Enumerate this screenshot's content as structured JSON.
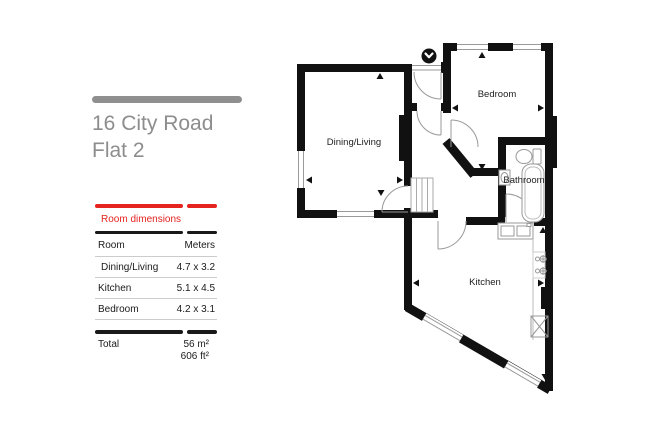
{
  "address": {
    "line1": "16 City Road",
    "line2": "Flat 2"
  },
  "table": {
    "title": "Room dimensions",
    "col_room": "Room",
    "col_meters": "Meters",
    "rows": [
      {
        "room": "Dining/Living",
        "meters": "4.7 x 3.2"
      },
      {
        "room": "Kitchen",
        "meters": "5.1 x 4.5"
      },
      {
        "room": "Bedroom",
        "meters": "4.2 x 3.1"
      }
    ],
    "total_label": "Total",
    "total_m": "56 m²",
    "total_ft": "606 ft²"
  },
  "floorplan": {
    "labels": {
      "dining": "Dining/Living",
      "bedroom": "Bedroom",
      "bathroom": "Bathroom",
      "kitchen": "Kitchen"
    },
    "entrance_icon": "chevron-down-circle"
  },
  "colors": {
    "accent_red": "#e5231f",
    "wall_black": "#111111",
    "title_gray": "#8d8d8d"
  }
}
